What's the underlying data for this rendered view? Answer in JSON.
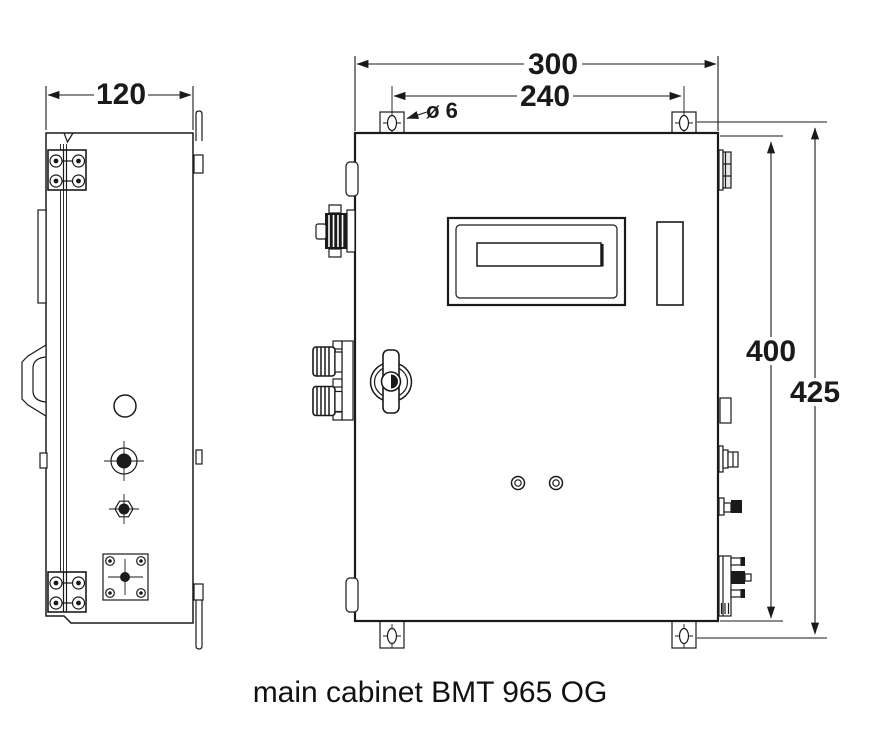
{
  "caption": "main cabinet BMT 965 OG",
  "dims": {
    "width_side": "120",
    "width_front": "300",
    "hole_spacing": "240",
    "hole_dia": "ø 6",
    "height_body": "400",
    "height_overall": "425"
  },
  "colors": {
    "line": "#1a1a1a",
    "background": "#ffffff"
  }
}
